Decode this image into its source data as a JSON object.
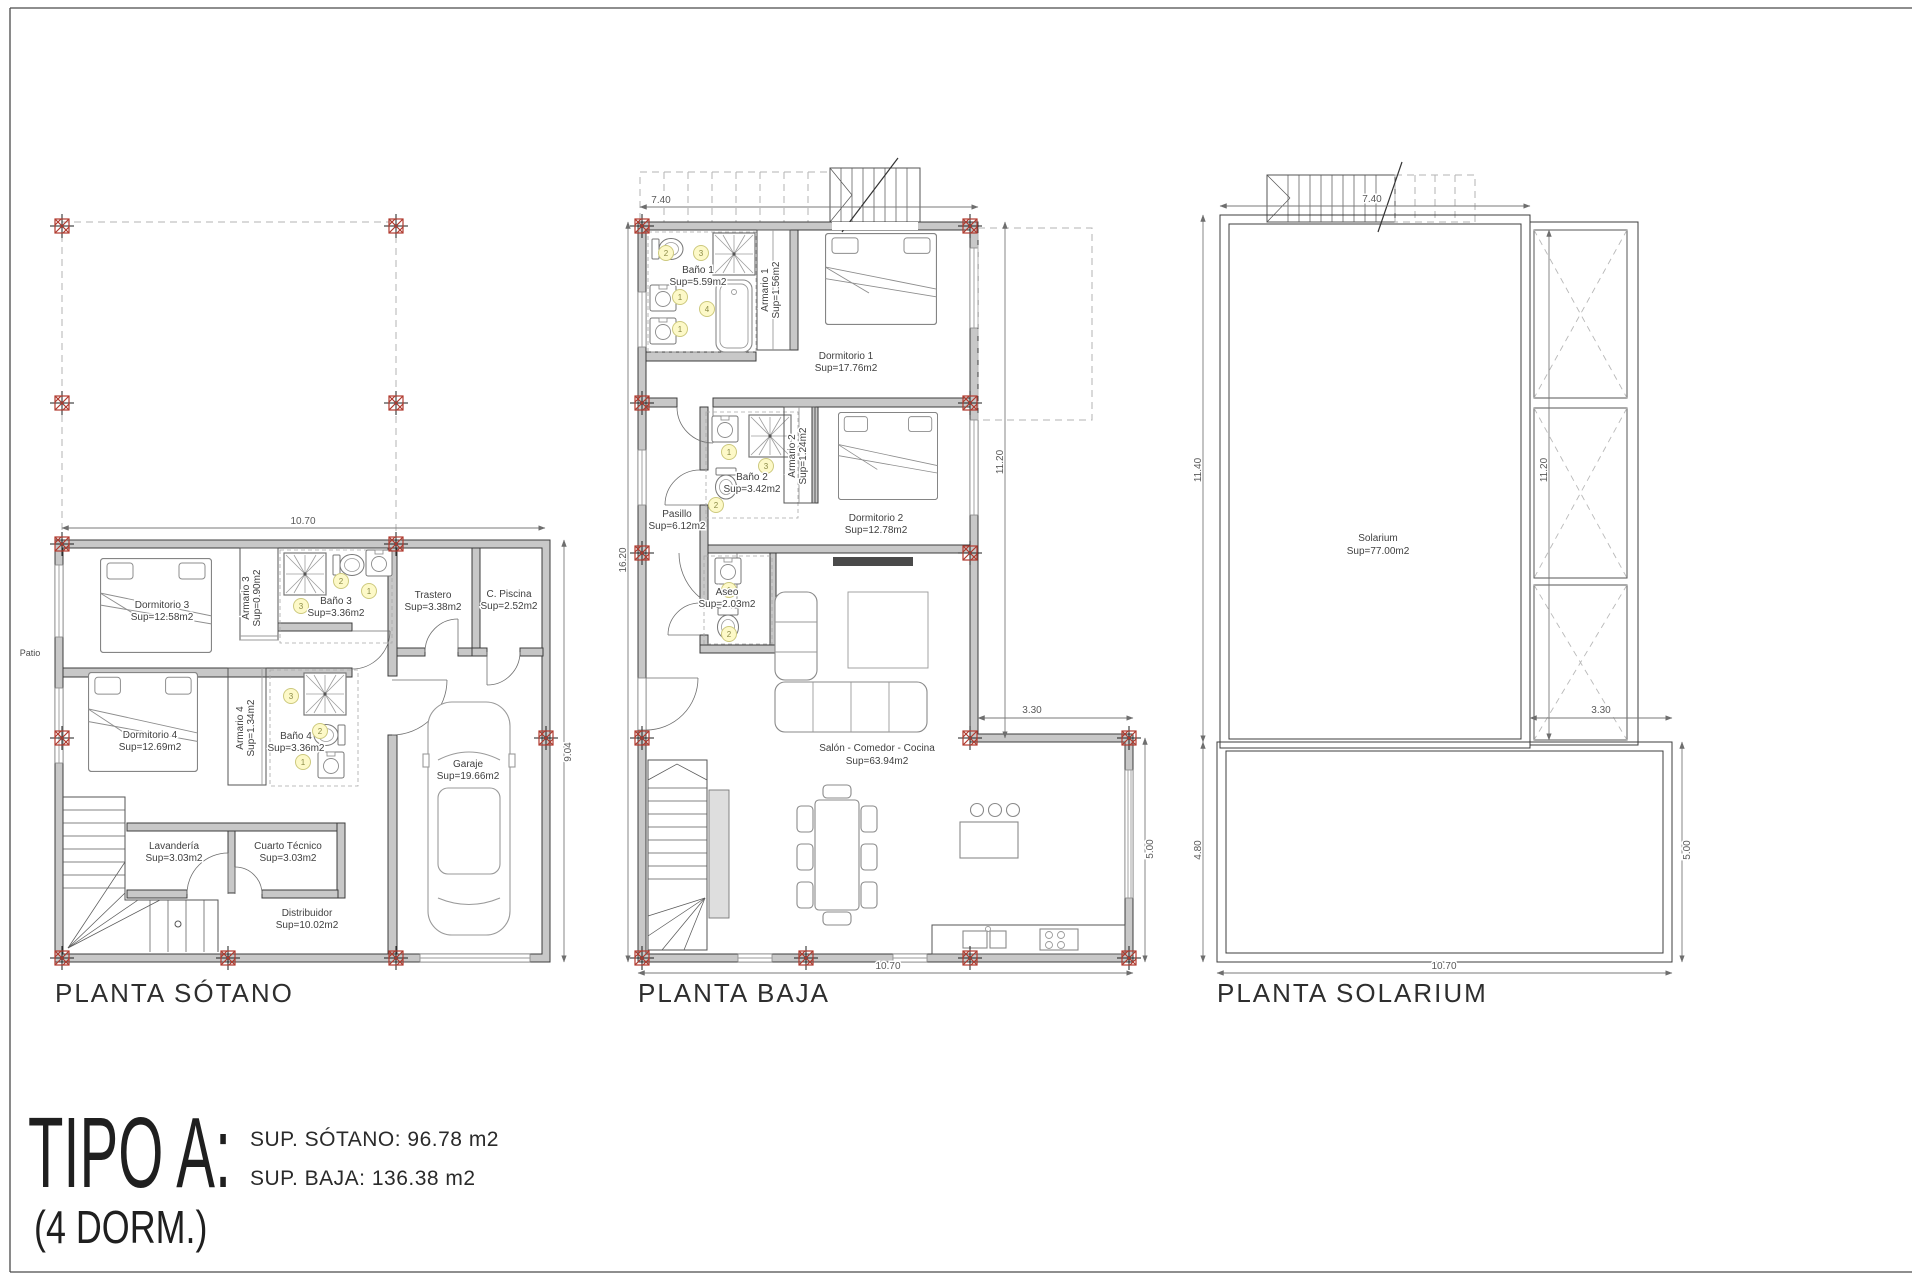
{
  "title_block": {
    "type_label": "TIPO A:",
    "dorm_label": "(4 DORM.)",
    "sup_sotano": "SUP. SÓTANO: 96.78 m2",
    "sup_baja": "SUP. BAJA: 136.38 m2"
  },
  "colors": {
    "wall_fill": "#c8c8c8",
    "column_marker_red": "#b03a2e",
    "badge_yellow": "#fdf9c8"
  },
  "plans": {
    "sotano": {
      "title": "PLANTA SÓTANO",
      "patio_label": "Patio",
      "dims": {
        "top": "10.70",
        "right": "9.04"
      },
      "rooms": {
        "dormitorio3": {
          "name": "Dormitorio 3",
          "sup": "Sup=12.58m2"
        },
        "armario3": {
          "name": "Armario 3",
          "sup": "Sup=0.90m2"
        },
        "bano3": {
          "name": "Baño 3",
          "sup": "Sup=3.36m2",
          "badges": [
            "3",
            "2",
            "1"
          ]
        },
        "trastero": {
          "name": "Trastero",
          "sup": "Sup=3.38m2"
        },
        "cpiscina": {
          "name": "C. Piscina",
          "sup": "Sup=2.52m2"
        },
        "dormitorio4": {
          "name": "Dormitorio 4",
          "sup": "Sup=12.69m2"
        },
        "armario4": {
          "name": "Armario 4",
          "sup": "Sup=1.34m2"
        },
        "bano4": {
          "name": "Baño 4",
          "sup": "Sup=3.36m2",
          "badges": [
            "3",
            "2",
            "1"
          ]
        },
        "garaje": {
          "name": "Garaje",
          "sup": "Sup=19.66m2"
        },
        "lavanderia": {
          "name": "Lavandería",
          "sup": "Sup=3.03m2"
        },
        "cuarto_tecnico": {
          "name": "Cuarto Técnico",
          "sup": "Sup=3.03m2"
        },
        "distribuidor": {
          "name": "Distribuidor",
          "sup": "Sup=10.02m2"
        }
      }
    },
    "baja": {
      "title": "PLANTA BAJA",
      "dims": {
        "top": "7.40",
        "left": "16.20",
        "right": "11.20",
        "step": "3.30",
        "right_lower": "5.00",
        "bottom": "10.70"
      },
      "rooms": {
        "bano1": {
          "name": "Baño 1",
          "sup": "Sup=5.59m2",
          "badges": [
            "2",
            "3",
            "1",
            "4",
            "1"
          ]
        },
        "armario1": {
          "name": "Armario 1",
          "sup": "Sup=1.56m2"
        },
        "dormitorio1": {
          "name": "Dormitorio 1",
          "sup": "Sup=17.76m2"
        },
        "bano2": {
          "name": "Baño 2",
          "sup": "Sup=3.42m2",
          "badges": [
            "1",
            "3",
            "2"
          ]
        },
        "armario2": {
          "name": "Armario 2",
          "sup": "Sup=1.24m2"
        },
        "dormitorio2": {
          "name": "Dormitorio 2",
          "sup": "Sup=12.78m2"
        },
        "pasillo": {
          "name": "Pasillo",
          "sup": "Sup=6.12m2"
        },
        "aseo": {
          "name": "Aseo",
          "sup": "Sup=2.03m2",
          "badges": [
            "1",
            "2"
          ]
        },
        "salon": {
          "name": "Salón - Comedor - Cocina",
          "sup": "Sup=63.94m2"
        }
      }
    },
    "solarium": {
      "title": "PLANTA SOLARIUM",
      "dims": {
        "top": "7.40",
        "left_upper": "11.40",
        "inner": "11.20",
        "step": "3.30",
        "left_lower": "4.80",
        "right_lower": "5.00",
        "bottom": "10.70"
      },
      "rooms": {
        "solarium": {
          "name": "Solarium",
          "sup": "Sup=77.00m2"
        }
      }
    }
  }
}
